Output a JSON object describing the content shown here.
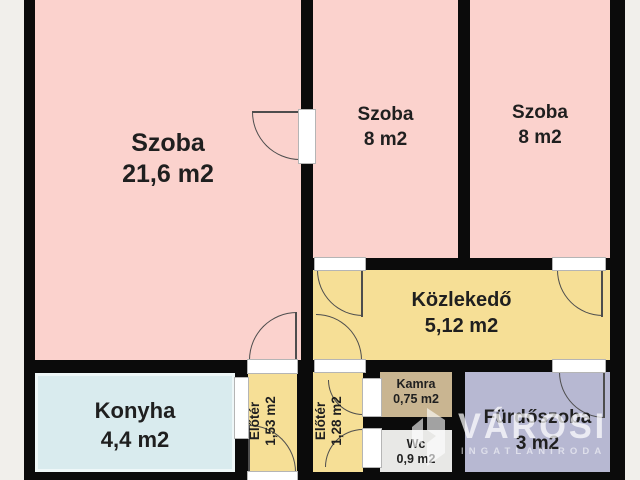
{
  "floorplan": {
    "rooms": [
      {
        "name": "szoba-large",
        "label": "Szoba",
        "area": "21,6 m2",
        "color": "#fbd2cd"
      },
      {
        "name": "szoba-middle",
        "label": "Szoba",
        "area": "8 m2",
        "color": "#fbd2cd"
      },
      {
        "name": "szoba-right",
        "label": "Szoba",
        "area": "8 m2",
        "color": "#fbd2cd"
      },
      {
        "name": "kozlekedo",
        "label": "Közlekedő",
        "area": "5,12 m2",
        "color": "#f6df96"
      },
      {
        "name": "konyha",
        "label": "Konyha",
        "area": "4,4 m2",
        "color": "#d9ebee"
      },
      {
        "name": "eloter-1",
        "label": "Előtér",
        "area": "1,53 m2",
        "color": "#f6df96"
      },
      {
        "name": "eloter-2",
        "label": "Előtér",
        "area": "1,28 m2",
        "color": "#f6df96"
      },
      {
        "name": "kamra",
        "label": "Kamra",
        "area": "0,75 m2",
        "color": "#c9b591"
      },
      {
        "name": "wc",
        "label": "Wc",
        "area": "0,9 m2",
        "color": "#e8e8e6"
      },
      {
        "name": "furdoszoba",
        "label": "Fürdőszoba",
        "area": "3 m2",
        "color": "#b7b8d2"
      }
    ],
    "watermark": {
      "brand": "VÁROSI",
      "subtitle": "INGATLANIRODA"
    },
    "colors": {
      "wall": "#0b0b0b",
      "background": "#f1efeb",
      "door_line": "#4d4d4d",
      "label_text": "#1f1f1f"
    }
  }
}
